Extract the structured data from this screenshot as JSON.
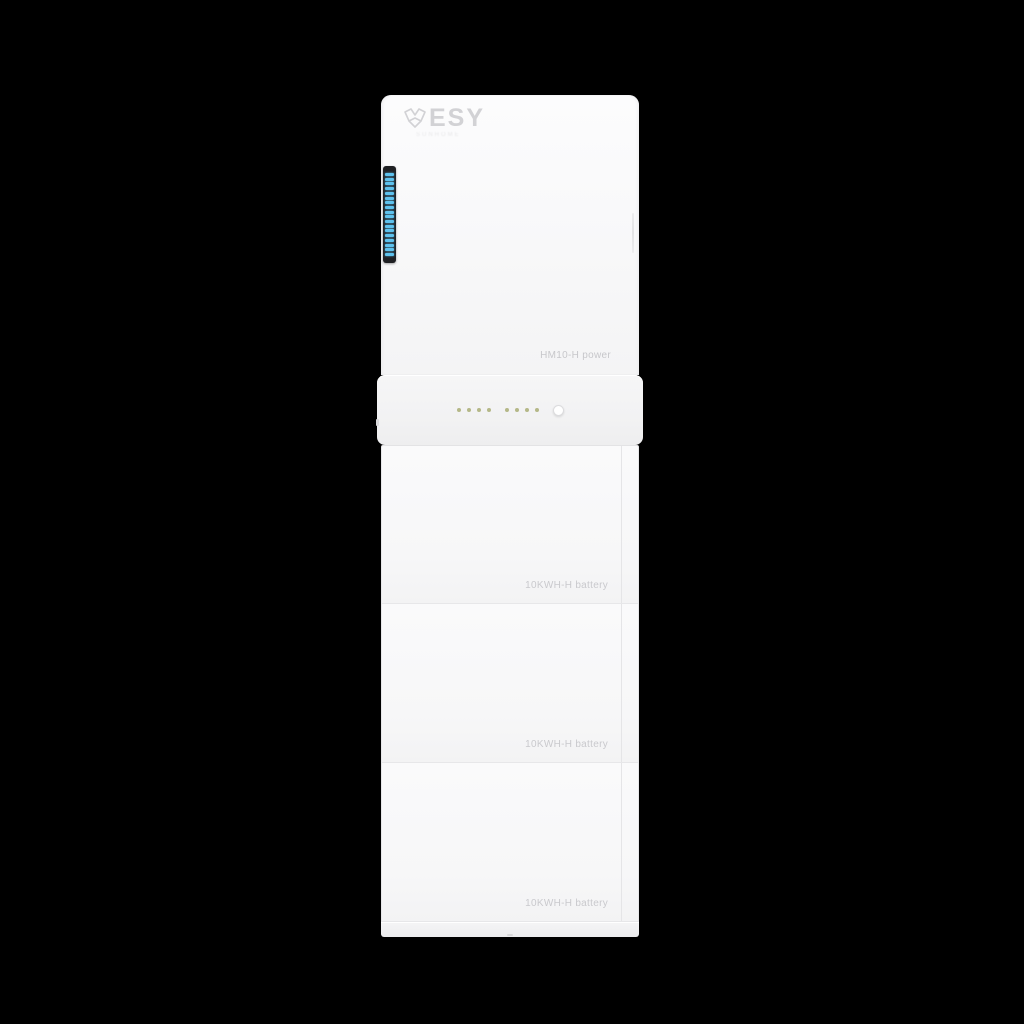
{
  "product": {
    "brand": "ESY",
    "tagline": "SUNHOME",
    "power_module_label": "HM10-H power"
  },
  "led_strip": {
    "segments": 18,
    "color": "#5ec2ee"
  },
  "indicators": {
    "group1_dots": 4,
    "group2_dots": 4,
    "dot_color": "#a9ad74",
    "has_round_button": true
  },
  "batteries": [
    {
      "label": "10KWH-H battery"
    },
    {
      "label": "10KWH-H battery"
    },
    {
      "label": "10KWH-H battery"
    }
  ],
  "colors": {
    "background": "#000000",
    "body_white": "#f7f7f8",
    "panel_line": "#e5e5e7",
    "label_gray": "#c9c9cd",
    "accent_blue": "#5ec2ee",
    "led_olive": "#a9ad74"
  }
}
